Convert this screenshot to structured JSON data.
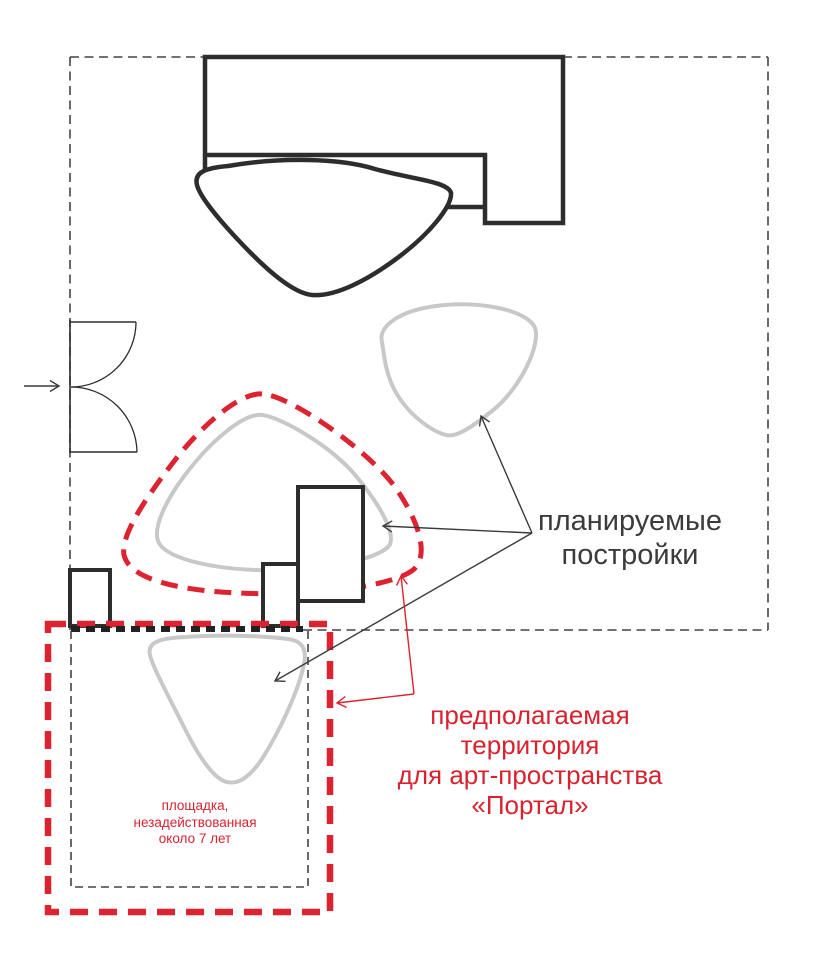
{
  "diagram": {
    "labels": {
      "planned_buildings": "планируемые\nпостройки",
      "proposed_territory": "предполагаемая\nтерритория\nдля арт-пространства\n«Портал»",
      "unused_site_note": "площадка,\nнезадействованная\nоколо 7 лет"
    },
    "colors": {
      "accent_red": "#dd2230",
      "outline_black": "#2d2d2d",
      "planned_gray": "#c8c8c8",
      "boundary_gray": "#444444",
      "background": "#ffffff"
    }
  }
}
